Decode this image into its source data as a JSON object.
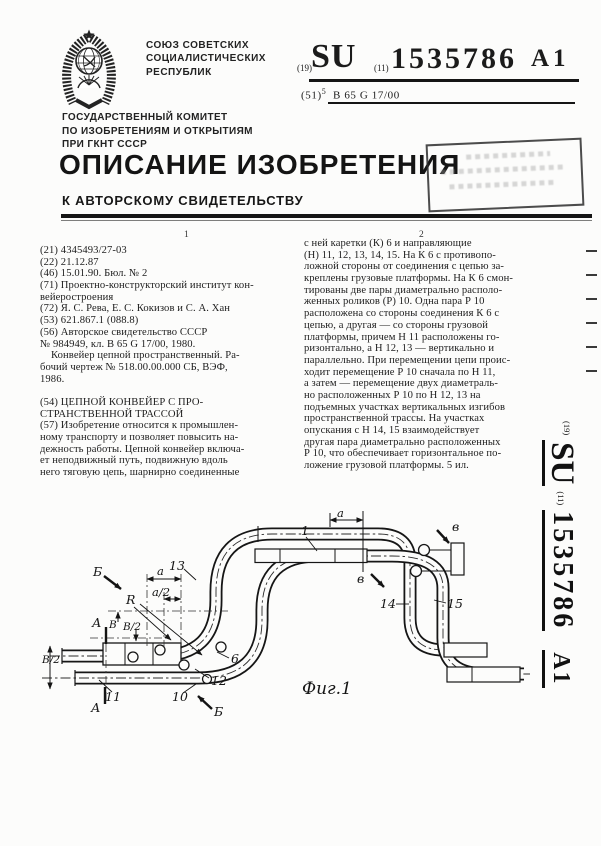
{
  "header": {
    "country_lines": [
      "СОЮЗ СОВЕТСКИХ",
      "СОЦИАЛИСТИЧЕСКИХ",
      "РЕСПУБЛИК"
    ],
    "code19": "(19)",
    "su": "SU",
    "code11": "(11)",
    "number": "1535786",
    "kind": "А1",
    "ipc_prefix": "(51)",
    "ipc_edition": "5",
    "ipc_class": "В 65 G 17/00",
    "committee_lines": [
      "ГОСУДАРСТВЕННЫЙ КОМИТЕТ",
      "ПО ИЗОБРЕТЕНИЯМ И ОТКРЫТИЯМ",
      "ПРИ ГКНТ СССР"
    ],
    "doc_title": "ОПИСАНИЕ ИЗОБРЕТЕНИЯ",
    "doc_subtitle": "К АВТОРСКОМУ СВИДЕТЕЛЬСТВУ"
  },
  "columns": {
    "marker_left": "1",
    "marker_right": "2",
    "left_lines": [
      "(21) 4345493/27-03",
      "(22) 21.12.87",
      "(46) 15.01.90. Бюл. № 2",
      "(71) Проектно-конструкторский институт кон-",
      "вейеростроения",
      "(72) Я. С. Рева, Е. С. Кокизов и С. А. Хан",
      "(53) 621.867.1 (088.8)",
      "(56) Авторское свидетельство СССР",
      "№ 984949, кл. В 65 G 17/00, 1980.",
      "    Конвейер цепной пространственный. Ра-",
      "бочий чертеж № 518.00.00.000 СБ, ВЭФ,",
      "1986.",
      "",
      "(54) ЦЕПНОЙ КОНВЕЙЕР С ПРО-",
      "СТРАНСТВЕННОЙ ТРАССОЙ",
      "(57) Изобретение относится к промышлен-",
      "ному транспорту и позволяет повысить на-",
      "дежность работы. Цепной конвейер включа-",
      "ет неподвижный путь, подвижную вдоль",
      "него тяговую цепь, шарнирно соединенные"
    ],
    "right_lines": [
      "с ней каретки (К) 6 и направляющие",
      "(Н) 11, 12, 13, 14, 15. На К 6 с противопо-",
      "ложной стороны от соединения с цепью за-",
      "креплены грузовые платформы. На К 6 смон-",
      "тированы две пары диаметрально располо-",
      "женных роликов (Р) 10. Одна пара Р 10",
      "расположена со стороны соединения К 6 с",
      "цепью, а другая — со стороны грузовой",
      "платформы, причем Н 11 расположены го-",
      "ризонтально, а Н 12, 13 — вертикально и",
      "параллельно. При перемещении цепи проис-",
      "ходит перемещение Р 10 сначала по Н 11,",
      "а затем — перемещение двух диаметраль-",
      "но расположенных Р 10 по Н 12, 13 на",
      "подъемных участках вертикальных изгибов",
      "пространственной трассы. На участках",
      "опускания с Н 14, 15 взаимодействует",
      "другая пара диаметрально расположенных",
      "Р 10, что обеспечивает горизонтальное по-",
      "ложение грузовой платформы. 5 ил."
    ]
  },
  "sidebar": {
    "code19": "(19)",
    "su": "SU",
    "code11": "(11)",
    "number": "1535786",
    "kind": "А1"
  },
  "figure": {
    "caption": "Фиг.1",
    "labels": {
      "n1": "1",
      "n6": "6",
      "n10": "10",
      "n11": "11",
      "n12": "12",
      "n13": "13",
      "n14": "14",
      "n15": "15",
      "r": "R",
      "dim_a_left": "a",
      "dim_a_half": "a/2",
      "dim_a_right": "a",
      "dim_b": "В",
      "dim_b_half": "В/2",
      "dim_b_half_edge": "В/2",
      "sec_a_top": "А",
      "sec_a_bottom": "А",
      "sec_b_top": "Б",
      "sec_b_bottom": "Б",
      "sec_v_top": "в",
      "sec_v_bottom": "в"
    }
  }
}
